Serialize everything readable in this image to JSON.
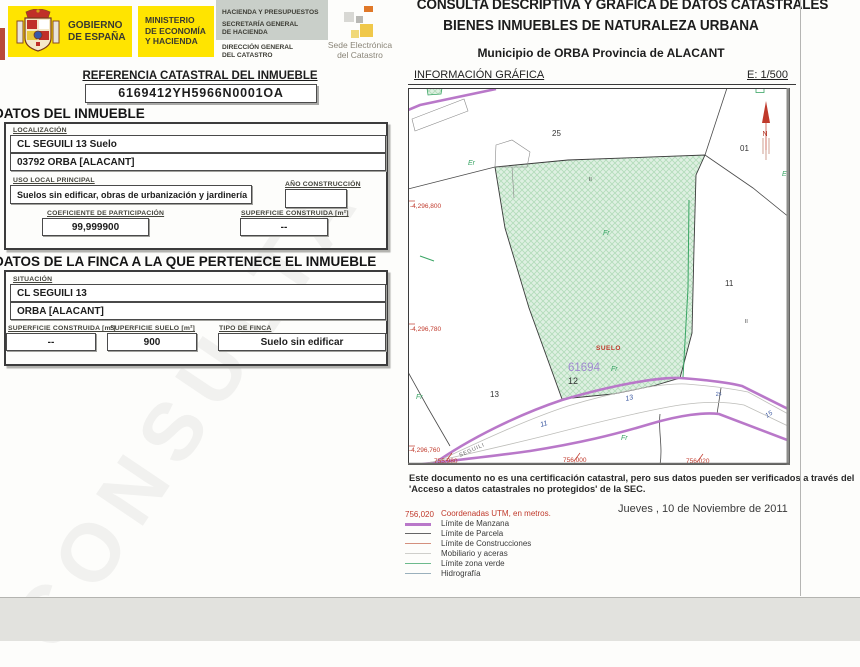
{
  "header": {
    "gobierno1": "GOBIERNO",
    "gobierno2": "DE ESPAÑA",
    "ministerio1": "MINISTERIO",
    "ministerio2": "DE ECONOMÍA",
    "ministerio3": "Y HACIENDA",
    "hacienda": "HACIENDA Y PRESUPUESTOS",
    "secretaria1": "SECRETARÍA GENERAL",
    "secretaria2": "DE HACIENDA",
    "direccion1": "DIRECCIÓN GENERAL",
    "direccion2": "DEL CATASTRO",
    "sede1": "Sede Electrónica",
    "sede2": "del Catastro"
  },
  "title": {
    "line1": "CONSULTA DESCRIPTIVA Y GRÁFICA DE DATOS CATASTRALES",
    "line2": "BIENES INMUEBLES DE NATURALEZA URBANA",
    "line3": "Municipio de ORBA Provincia de ALACANT",
    "info_left": "INFORMACIÓN GRÁFICA",
    "scale": "E: 1/500"
  },
  "referencia": {
    "label": "REFERENCIA CATASTRAL DEL INMUEBLE",
    "value": "6169412YH5966N0001OA"
  },
  "inmueble": {
    "heading": "DATOS DEL INMUEBLE",
    "localizacion_label": "LOCALIZACIÓN",
    "localizacion_line1": "CL SEGUILI 13 Suelo",
    "localizacion_line2": "03792 ORBA [ALACANT]",
    "uso_label": "USO LOCAL PRINCIPAL",
    "uso_value": "Suelos sin edificar, obras de urbanización y jardinería",
    "anio_label": "AÑO CONSTRUCCIÓN",
    "anio_value": "",
    "coef_label": "COEFICIENTE DE PARTICIPACIÓN",
    "coef_value": "99,999900",
    "sup_label": "SUPERFICIE CONSTRUIDA [m²]",
    "sup_value": "--"
  },
  "finca": {
    "heading": "DATOS DE LA FINCA A LA QUE PERTENECE EL INMUEBLE",
    "situacion_label": "SITUACIÓN",
    "situacion_line1": "CL SEGUILI 13",
    "situacion_line2": "ORBA [ALACANT]",
    "sup_constr_label": "SUPERFICIE CONSTRUIDA [m²]",
    "sup_constr_value": "--",
    "sup_suelo_label": "SUPERFICIE SUELO [m²]",
    "sup_suelo_value": "900",
    "tipo_label": "TIPO DE FINCA",
    "tipo_value": "Suelo sin edificar"
  },
  "map": {
    "parcels": {
      "p25": "25",
      "p01": "01",
      "p11": "11",
      "p12": "12",
      "p13": "13"
    },
    "manzana_number": "61694",
    "suelo_label": "SUELO",
    "street_name": "SEGUILI",
    "green_labels": {
      "er": "Er",
      "fr": "Fr",
      "e": "E"
    },
    "house_numbers": {
      "n11": "11",
      "n13": "13",
      "n2s": "2s",
      "n15": "15"
    },
    "floors_mark": "II",
    "north_letter": "N",
    "coords": {
      "y1": "-4,296,800",
      "y2": "-4,296,780",
      "y3": "-4,296,760",
      "x1": "755,980",
      "x2": "756,000",
      "x3": "756,020"
    }
  },
  "footer": {
    "disclaimer_line1": "Este documento no es una certificación catastral, pero sus datos pueden ser verificados a través del",
    "disclaimer_line2": "'Acceso a datos catastrales no protegidos' de la SEC.",
    "date": "Jueves , 10 de Noviembre de 2011"
  },
  "legend": {
    "coord_sample": "756,020",
    "items": [
      {
        "label": "Coordenadas UTM, en metros.",
        "color": "#c0392b"
      },
      {
        "label": "Límite de Manzana",
        "color": "#b978c9"
      },
      {
        "label": "Límite de Parcela",
        "color": "#666666"
      },
      {
        "label": "Límite de Construcciones",
        "color": "#d4907e"
      },
      {
        "label": "Mobiliario y aceras",
        "color": "#cfcfcb"
      },
      {
        "label": "Límite zona verde",
        "color": "#6cba8c"
      },
      {
        "label": "Hidrografía",
        "color": "#9ab0bc"
      }
    ]
  },
  "watermark": "CONSULTA",
  "colors": {
    "accent_yellow": "#ffe400",
    "limite_manzana_purple": "#b978c9",
    "coordinate_red": "#c0392b",
    "zona_verde_green": "#3aa565",
    "house_number_blue": "#3a57a0",
    "manzana_violet": "#a18ad0",
    "parcel_fill_green": "#def0e2"
  }
}
